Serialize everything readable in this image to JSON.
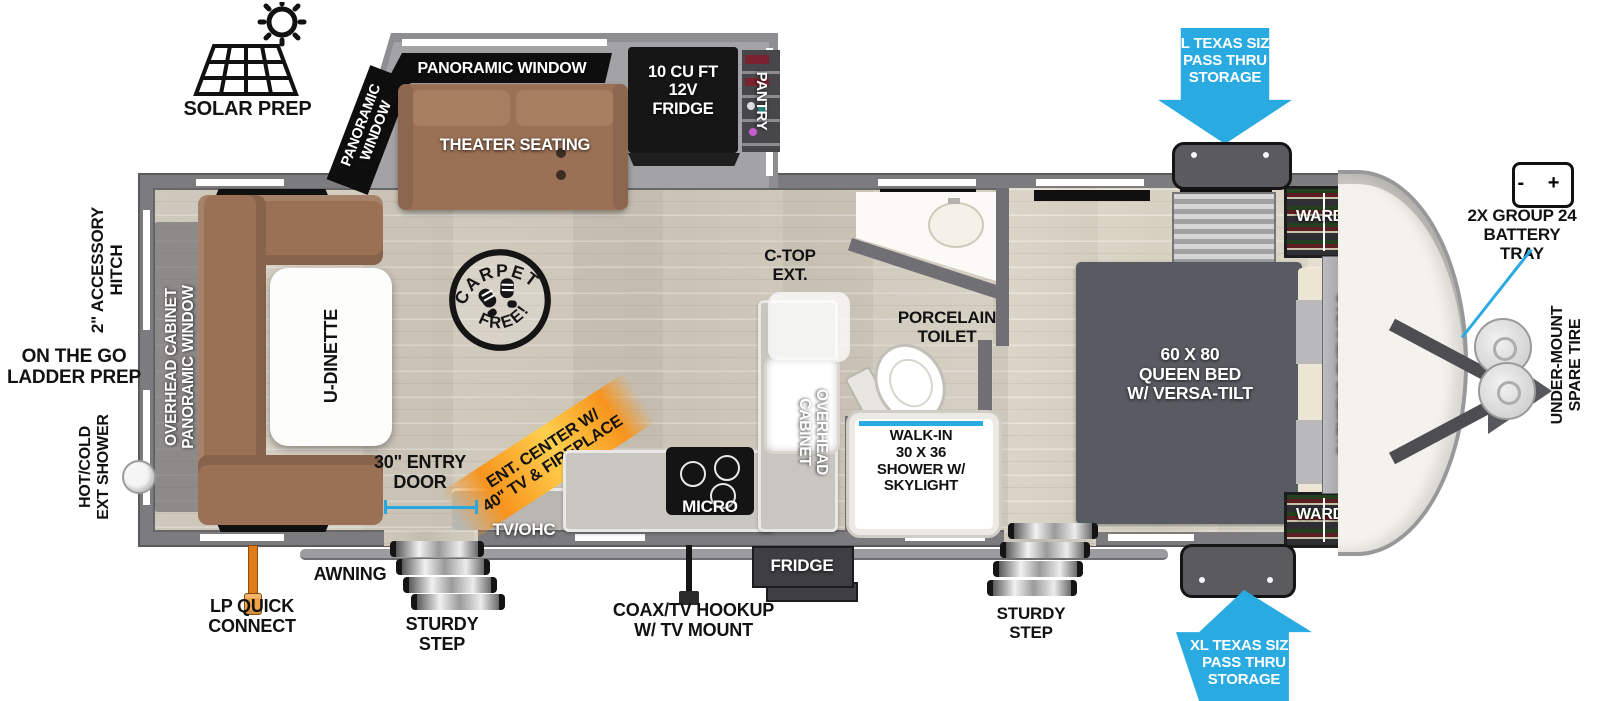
{
  "exterior": {
    "solar_prep": "SOLAR PREP",
    "pass_thru_top": "XL TEXAS SIZE\nPASS THRU\nSTORAGE",
    "pass_thru_bottom": "XL TEXAS SIZE\nPASS THRU\nSTORAGE",
    "battery_tray": "2X GROUP 24\nBATTERY\nTRAY",
    "battery_symbols": "-  +",
    "spare_tire": "UNDER-MOUNT\nSPARE TIRE",
    "accessory_hitch": "2\" ACCESSORY\nHITCH",
    "ladder_prep": "ON THE GO\nLADDER PREP",
    "ext_shower": "HOT/COLD\nEXT SHOWER",
    "lp_quick_connect": "LP QUICK\nCONNECT",
    "awning": "AWNING",
    "sturdy_step_left": "STURDY\nSTEP",
    "sturdy_step_right": "STURDY\nSTEP",
    "entry_door": "30\" ENTRY\nDOOR",
    "coax": "COAX/TV HOOKUP\nW/ TV MOUNT",
    "fridge_access": "FRIDGE"
  },
  "living": {
    "panoramic_window_top": "PANORAMIC WINDOW",
    "panoramic_window_angled": "PANORAMIC\nWINDOW",
    "theater_seating": "THEATER SEATING",
    "fridge": "10 CU FT\n12V\nFRIDGE",
    "pantry": "PANTRY",
    "carpet_top": "CARPET",
    "carpet_bottom": "FREE!",
    "ent_center": "ENT. CENTER W/\n40\" TV & FIREPLACE",
    "tv_ohc": "TV/OHC",
    "u_dinette": "U-DINETTE",
    "rear_wall": "OVERHEAD CABINET\nPANORAMIC WINDOW"
  },
  "kitchen": {
    "micro": "MICRO",
    "c_top_ext": "C-TOP\nEXT.",
    "overhead_cabinet": "OVERHEAD\nCABINET"
  },
  "bath": {
    "toilet": "PORCELAIN\nTOILET",
    "shower": "WALK-IN\n30 X 36\nSHOWER W/\nSKYLIGHT"
  },
  "bedroom": {
    "bed": "60 X  80\nQUEEN BED\nW/ VERSA-TILT",
    "ward_top": "WARD",
    "ward_bottom": "WARD",
    "overhead_cabinets": "OVERHEAD CABINETS"
  },
  "colors": {
    "arrow_blue": "#29abe2",
    "accent_orange": "#f7941d",
    "sofa_brown": "#9b7156",
    "bed_gray": "#585c62",
    "wall_gray": "#7c7c7e"
  }
}
